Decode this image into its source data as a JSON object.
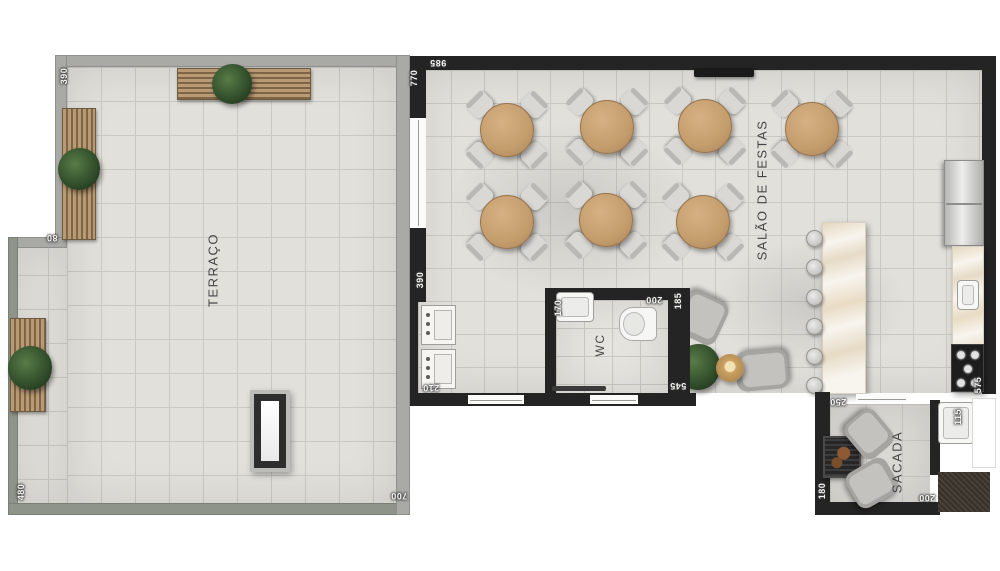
{
  "floorplan": {
    "rooms": {
      "terraco": "TERRAÇO",
      "salao_de_festas": "SALÃO DE FESTAS",
      "wc": "WC",
      "sacada": "SACADA"
    },
    "dims": {
      "terraco_top_left": "390",
      "terraco_step": "80",
      "terraco_left": "480",
      "terraco_bottom": "700",
      "salao_left": "770",
      "salao_top": "985",
      "hall_left": "390",
      "lavabo_bottom": "210",
      "wc_sink": "170",
      "wc_top": "200",
      "wc_right": "185",
      "wc_bottom": "545",
      "kitchen_bottom": "575",
      "sacada_top": "250",
      "sacada_left": "180",
      "sacada_bottom": "200",
      "sacada_sink": "115"
    },
    "furniture": {
      "dining_tables": 7,
      "chairs_per_table": 4,
      "bar_stools": 6,
      "terrace_benches": 3,
      "lounge_armchairs": 2,
      "balcony_chairs": 2
    },
    "colors": {
      "wall_dark": "#242424",
      "wall_gray": "#a9a9a5",
      "wall_green_gray": "#8e948a",
      "floor_tile": "#e2e0db",
      "table_wood": "#c49d6d",
      "chair_gray": "#d9d8d5",
      "plant_green": "#33502c",
      "marble": "#f8f5ef"
    }
  }
}
